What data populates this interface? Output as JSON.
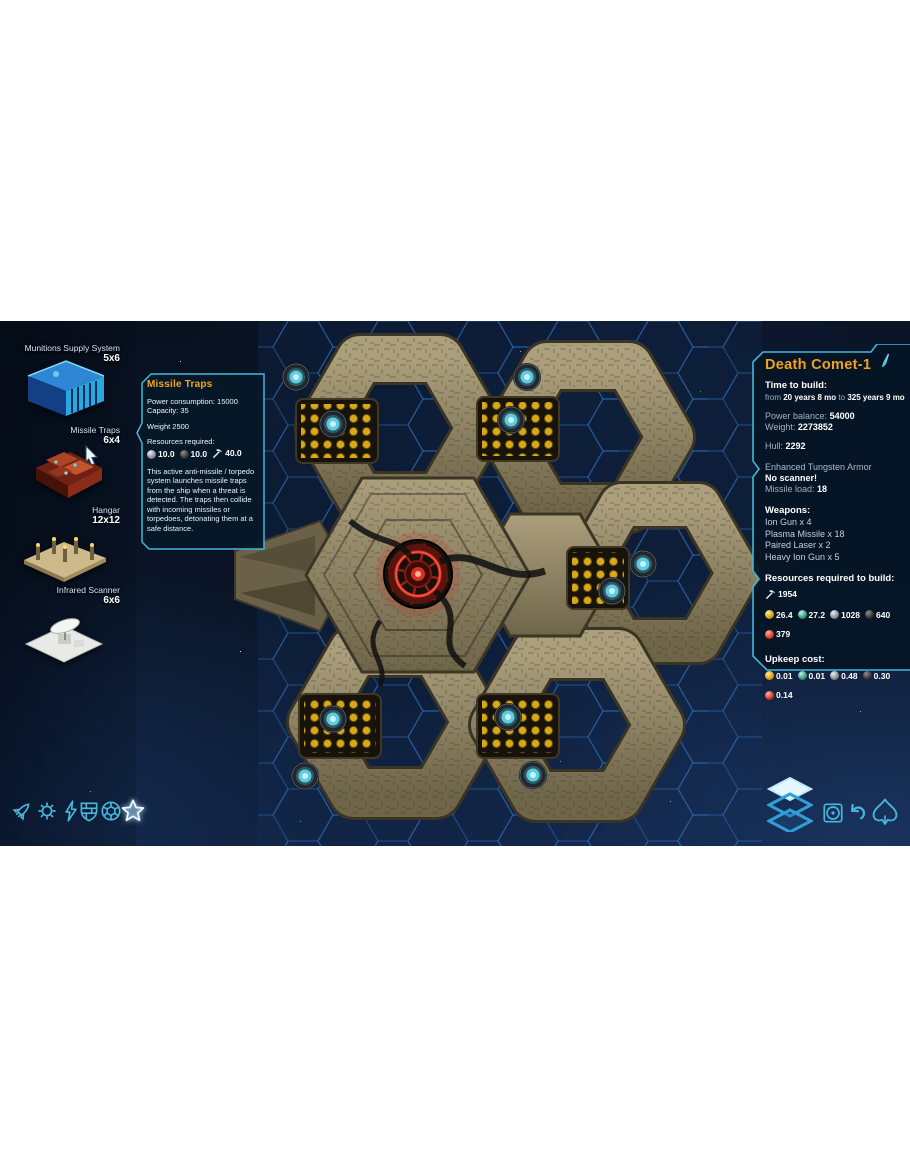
{
  "colors": {
    "accent_cyan": "#43b6d8",
    "title_orange": "#f2a11b",
    "panel_bg": "rgba(6,22,38,0.93)",
    "hull_tan": "#a79b77",
    "core_red": "#d83020",
    "turret_cyan": "#5ecbde",
    "missile_dot_amber": "#d8a818"
  },
  "sidebar": {
    "items": [
      {
        "name": "Munitions Supply System",
        "size": "5x6",
        "icon": "munitions-thumbnail"
      },
      {
        "name": "Missile Traps",
        "size": "6x4",
        "icon": "missile-traps-thumbnail"
      },
      {
        "name": "Hangar",
        "size": "12x12",
        "icon": "hangar-thumbnail"
      },
      {
        "name": "Infrared Scanner",
        "size": "6x6",
        "icon": "infrared-scanner-thumbnail"
      }
    ]
  },
  "tooltip": {
    "title": "Missile Traps",
    "power_consumption": "Power consumption: 15000",
    "capacity": "Capacity: 35",
    "weight": "Weight 2500",
    "resources_label": "Resources required:",
    "resources": {
      "rows": [
        [
          {
            "icon": "metal-sphere-icon",
            "value": "10.0"
          },
          {
            "icon": "carbon-sphere-icon",
            "value": "10.0"
          },
          {
            "icon": "pickaxe-icon",
            "value": "40.0"
          }
        ]
      ]
    },
    "description": "This active anti-missile / torpedo system launches missile traps from the ship when a threat is detected. The traps then collide with incoming missiles or torpedoes, detonating them at a safe distance."
  },
  "ship_panel": {
    "title": "Death Comet-1",
    "edit_icon": "pencil-icon",
    "time_to_build": {
      "label": "Time to build:",
      "from_word": "from",
      "from_value": "20 years 8 mo",
      "to_word": "to",
      "to_value": "325 years 9 mo"
    },
    "power_balance": {
      "label": "Power balance:",
      "value": "54000"
    },
    "weight": {
      "label": "Weight:",
      "value": "2273852"
    },
    "hull": {
      "label": "Hull:",
      "value": "2292"
    },
    "armor": "Enhanced Tungsten Armor",
    "scanner": "No scanner!",
    "missile_load": {
      "label": "Missile load:",
      "value": "18"
    },
    "weapons": {
      "label": "Weapons:",
      "items": [
        "Ion Gun x 4",
        "Plasma Missile x 18",
        "Paired Laser x 2",
        "Heavy Ion Gun x 5"
      ]
    },
    "build_resources": {
      "label": "Resources required to build:",
      "rows": [
        [
          {
            "icon": "pickaxe-icon",
            "value": "1954"
          }
        ],
        [
          {
            "icon": "gold-sphere-icon",
            "value": "26.4"
          },
          {
            "icon": "teal-sphere-icon",
            "value": "27.2"
          },
          {
            "icon": "metal-sphere-icon",
            "value": "1028"
          },
          {
            "icon": "carbon-sphere-icon",
            "value": "640"
          }
        ],
        [
          {
            "icon": "red-sphere-icon",
            "value": "379"
          }
        ]
      ]
    },
    "upkeep": {
      "label": "Upkeep cost:",
      "rows": [
        [
          {
            "icon": "gold-sphere-icon",
            "value": "0.01"
          },
          {
            "icon": "teal-sphere-icon",
            "value": "0.01"
          },
          {
            "icon": "metal-sphere-icon",
            "value": "0.48"
          },
          {
            "icon": "carbon-sphere-icon",
            "value": "0.30"
          }
        ],
        [
          {
            "icon": "red-sphere-icon",
            "value": "0.14"
          }
        ]
      ]
    }
  },
  "toolbar_left": {
    "tabs": [
      {
        "icon": "missile-icon"
      },
      {
        "icon": "gear-icon"
      },
      {
        "icon": "lightning-icon"
      },
      {
        "icon": "shield-icon"
      },
      {
        "icon": "hexball-icon"
      },
      {
        "icon": "star-icon",
        "selected": true
      }
    ]
  },
  "toolbar_right": {
    "buttons": [
      {
        "icon": "layers-icon"
      },
      {
        "icon": "camera-target-icon"
      },
      {
        "icon": "undo-icon"
      },
      {
        "icon": "spade-icon"
      }
    ]
  }
}
